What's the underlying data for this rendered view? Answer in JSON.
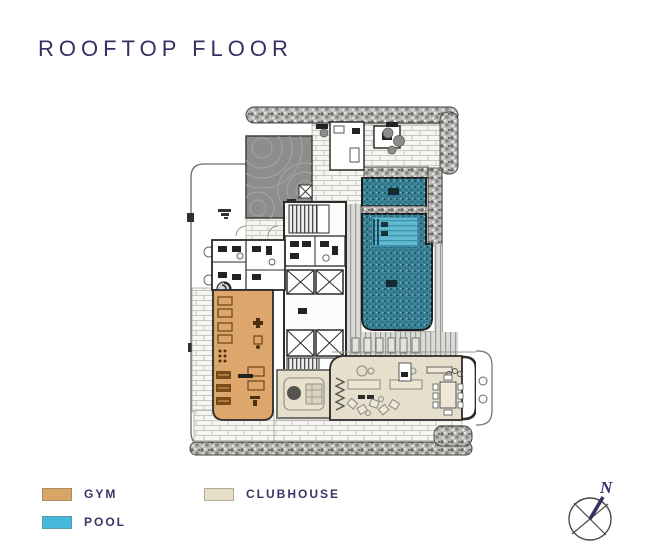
{
  "title": "ROOFTOP FLOOR",
  "legend": {
    "items": [
      {
        "label": "GYM",
        "color": "#D9A565"
      },
      {
        "label": "POOL",
        "color": "#45B8DE"
      },
      {
        "label": "CLUBHOUSE",
        "color": "#E7DFC9"
      }
    ]
  },
  "compass": {
    "north_label": "N"
  },
  "colors": {
    "title_text": "#343063",
    "plan_pool": "#3A8196",
    "plan_pool_lap": "#63B9CF",
    "plan_gym": "#DCA66C",
    "plan_clubhouse": "#E6DFCB",
    "plan_wall": "#2B2B2B",
    "plan_deck_gray": "#8E8D8B"
  }
}
